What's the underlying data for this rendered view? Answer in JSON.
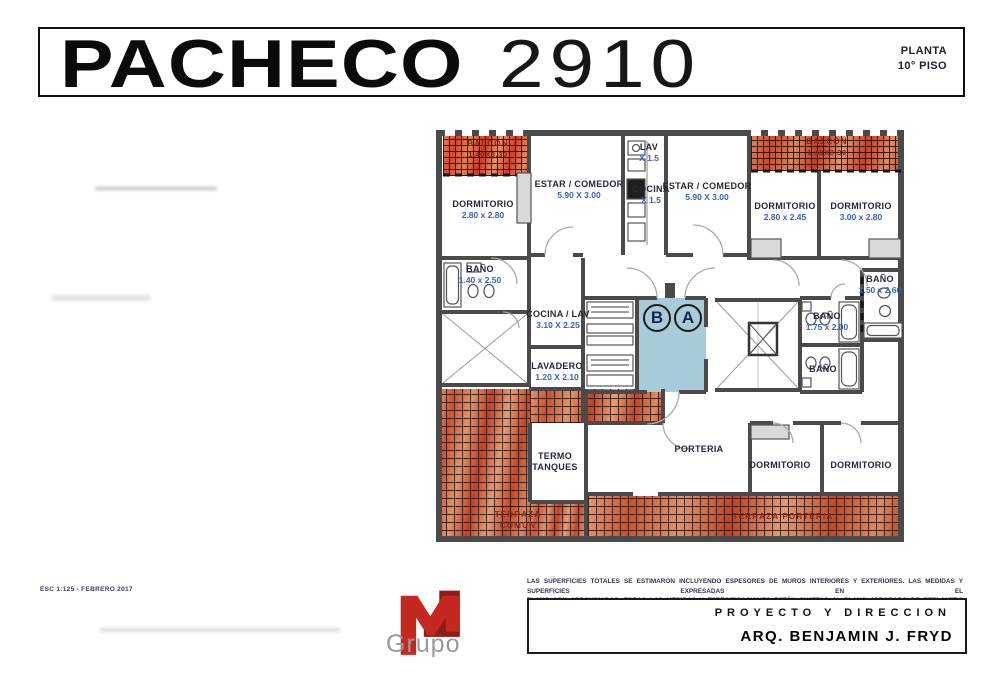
{
  "header": {
    "building": "PACHECO",
    "street_number": "2910",
    "plan_label": "PLANTA",
    "floor_label": "10° PISO"
  },
  "plan": {
    "unit_markers": {
      "b": "B",
      "a": "A"
    },
    "rooms": {
      "balcon_tl": {
        "name": "BALCON",
        "dim": "1.40X3.30"
      },
      "balcon_tr": {
        "name": "BALCON",
        "dim": "1.40X3.30"
      },
      "dorm_tl": {
        "name": "DORMITORIO",
        "dim": "2.80 x 2.80"
      },
      "estar_left": {
        "name": "ESTAR / COMEDOR",
        "dim": "5.90 X 3.00"
      },
      "lav": {
        "name": "LAV",
        "dim": "X 1.5"
      },
      "cocina": {
        "name": "COCINA",
        "dim": "X 1.5"
      },
      "estar_right": {
        "name": "ESTAR / COMEDOR",
        "dim": "5.90 X 3.00"
      },
      "dorm_tr1": {
        "name": "DORMITORIO",
        "dim": "2.80 x 2.45"
      },
      "dorm_tr2": {
        "name": "DORMITORIO",
        "dim": "3.00 x 2.80"
      },
      "bano_left": {
        "name": "BAÑO",
        "dim": "1.40 x 2.50"
      },
      "cocina_lav": {
        "name": "COCINA / LAV",
        "dim": "3.10 X 2.25"
      },
      "lavadero": {
        "name": "LAVADERO",
        "dim": "1.20 X 2.10"
      },
      "bano_mid1": {
        "name": "BAÑO",
        "dim": "1.75 x 2.00"
      },
      "bano_mid2": {
        "name": "BAÑO"
      },
      "bano_tr": {
        "name": "BAÑO",
        "dim": "1.50 x 2.60"
      },
      "termo": {
        "line1": "TERMO",
        "line2": "TANQUES"
      },
      "porteria": {
        "name": "PORTERIA"
      },
      "dorm_p1": {
        "name": "DORMITORIO"
      },
      "dorm_p2": {
        "name": "DORMITORIO"
      },
      "terraza_comun": {
        "line1": "TERRAZA",
        "line2": "COMUN"
      },
      "terraza_porteria": {
        "name": "TERRAZA PORTERIA"
      }
    }
  },
  "footer": {
    "scale_note": "ESC 1:125 - FEBRERO 2017",
    "logo": {
      "mark": "ML",
      "text": "Grupo"
    },
    "legal_line1": "LAS SUPERFICIES TOTALES SE ESTIMARON INCLUYENDO ESPESORES DE MUROS INTERIORES Y EXTERIORES. LAS MEDIDAS Y SUPERFICIES EXPRESADAS EN EL",
    "legal_line2": "PLANO SON APROXIMADAS. TODAS LAS MEDIDAS Y ESPECIFICACIONES ESTÁN SUJETAS AL PLANO APROBADO DE REPLANTEO DEFINITIVO DEL EDIFICIO.",
    "credit_title": "PROYECTO Y DIRECCION",
    "credit_name": "ARQ. BENJAMIN J. FRYD"
  },
  "colors": {
    "tile_red": "#cc4726",
    "hall_blue": "#a8cbd9",
    "wall_gray": "#4a4a4a",
    "dim_blue": "#3a5fc0",
    "terrace_label": "#882914",
    "logo_red": "#c4281f"
  }
}
